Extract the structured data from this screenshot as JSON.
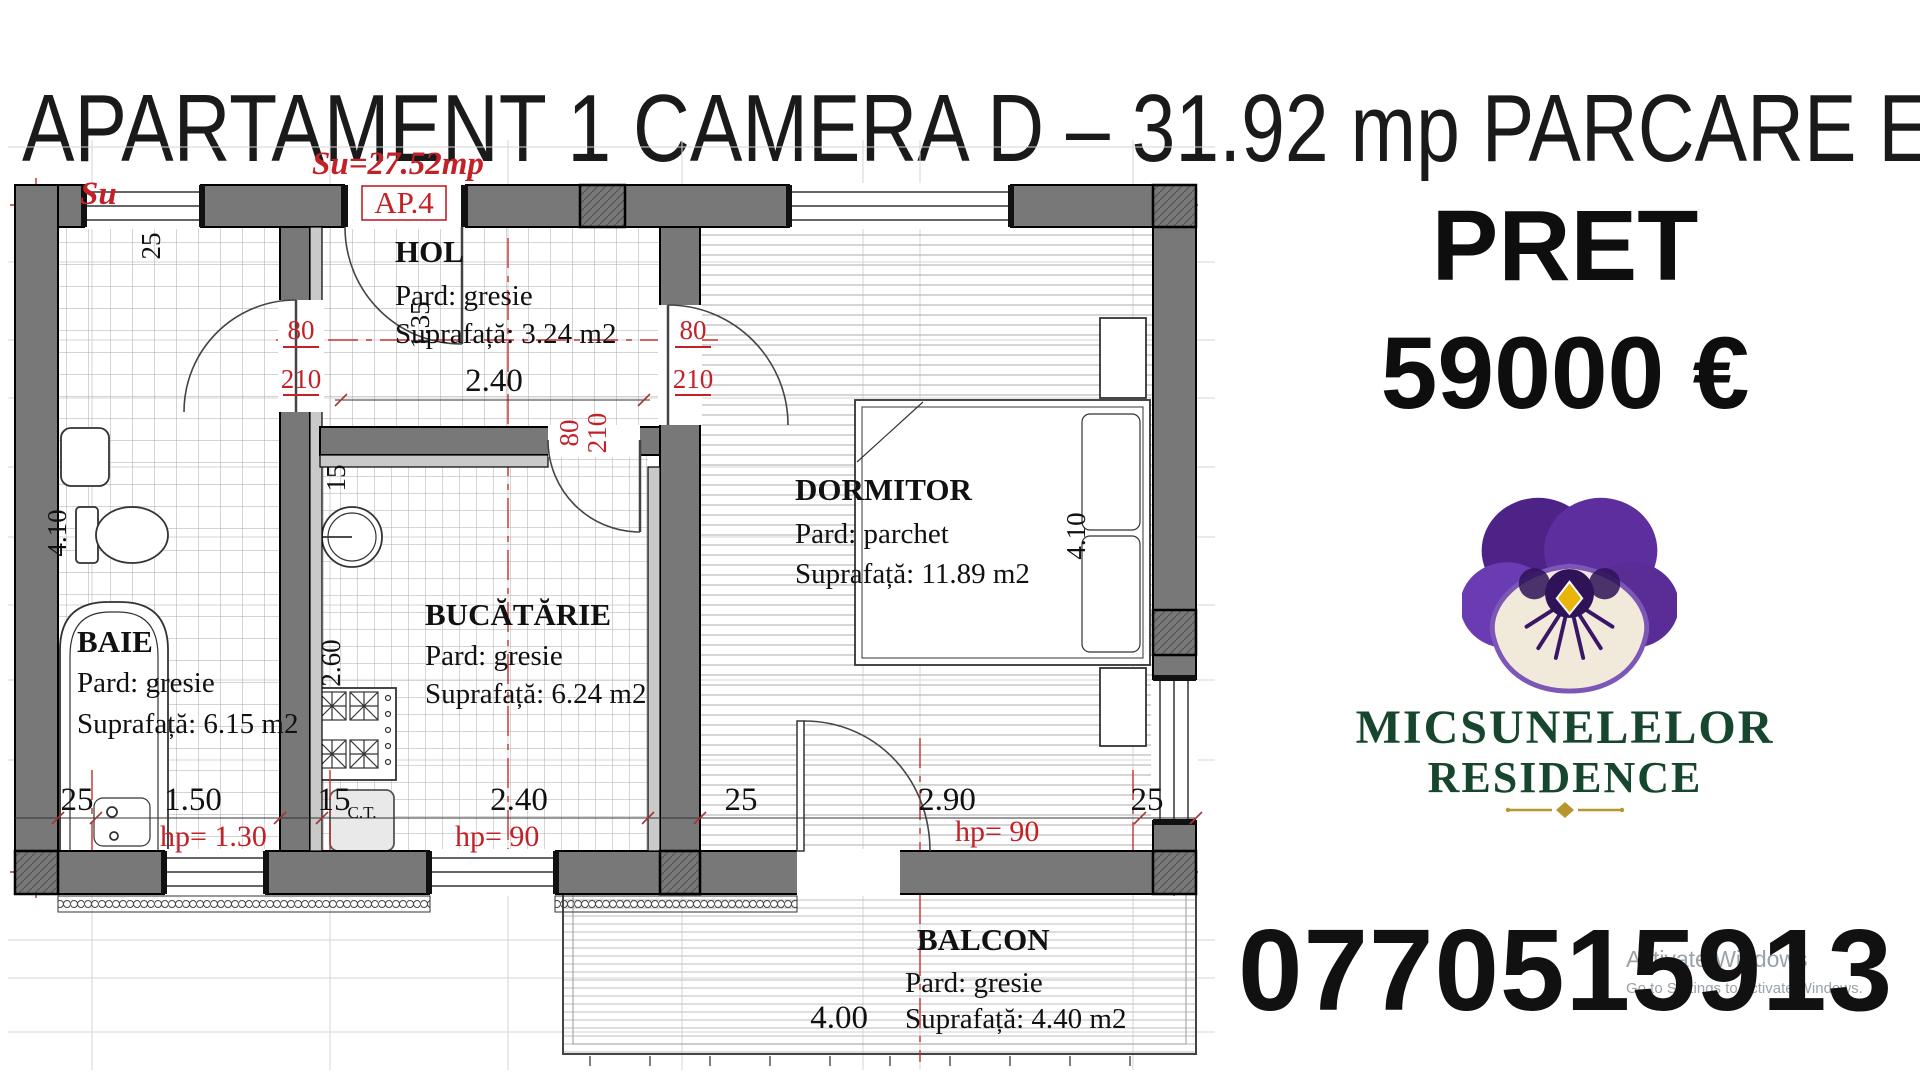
{
  "title": "APARTAMENT 1 CAMERA D – 31.92 mp PARCARE ET 2",
  "plan": {
    "su": "Su=27.52mp",
    "ap": "AP.4",
    "su_fragment": "Su",
    "rooms": {
      "hol": {
        "name": "HOL",
        "floor": "Pard: gresie",
        "area": "Suprafață: 3.24 m2"
      },
      "baie": {
        "name": "BAIE",
        "floor": "Pard: gresie",
        "area": "Suprafață: 6.15 m2"
      },
      "bucatarie": {
        "name": "BUCĂTĂRIE",
        "floor": "Pard: gresie",
        "area": "Suprafață: 6.24 m2"
      },
      "dormitor": {
        "name": "DORMITOR",
        "floor": "Pard: parchet",
        "area": "Suprafață: 11.89 m2"
      },
      "balcon": {
        "name": "BALCON",
        "floor": "Pard: gresie",
        "area": "Suprafață: 4.40 m2"
      }
    },
    "dims": {
      "top_25": "25",
      "left_80": "80",
      "left_210": "210",
      "right_80": "80",
      "right_210": "210",
      "v135": "1.35",
      "hol_w": "2.40",
      "door_80": "80",
      "door_210": "210",
      "k15": "15",
      "k260": "2.60",
      "baie_410": "4.10",
      "dorm_410": "4.10",
      "b25a": "25",
      "b150": "1.50",
      "b15": "15",
      "b240": "2.40",
      "b25b": "25",
      "b290": "2.90",
      "b25c": "25",
      "balcon_400": "4.00"
    },
    "notes": {
      "hp_baie": "hp= 1.30",
      "hp_buc": "hp= 90",
      "hp_dorm": "hp= 90",
      "ct": "C.T."
    }
  },
  "offer": {
    "label": "PRET",
    "price": "59000 €",
    "phone": "0770515913"
  },
  "brand": {
    "line1": "MICSUNELELOR",
    "line2": "RESIDENCE"
  },
  "watermark": {
    "line1": "Activate Windows",
    "line2": "Go to Settings to activate Windows."
  },
  "colors": {
    "annotation_red": "#c22127",
    "wall_gray": "#787878",
    "brand_green": "#17462e",
    "gold": "#b8962e"
  }
}
